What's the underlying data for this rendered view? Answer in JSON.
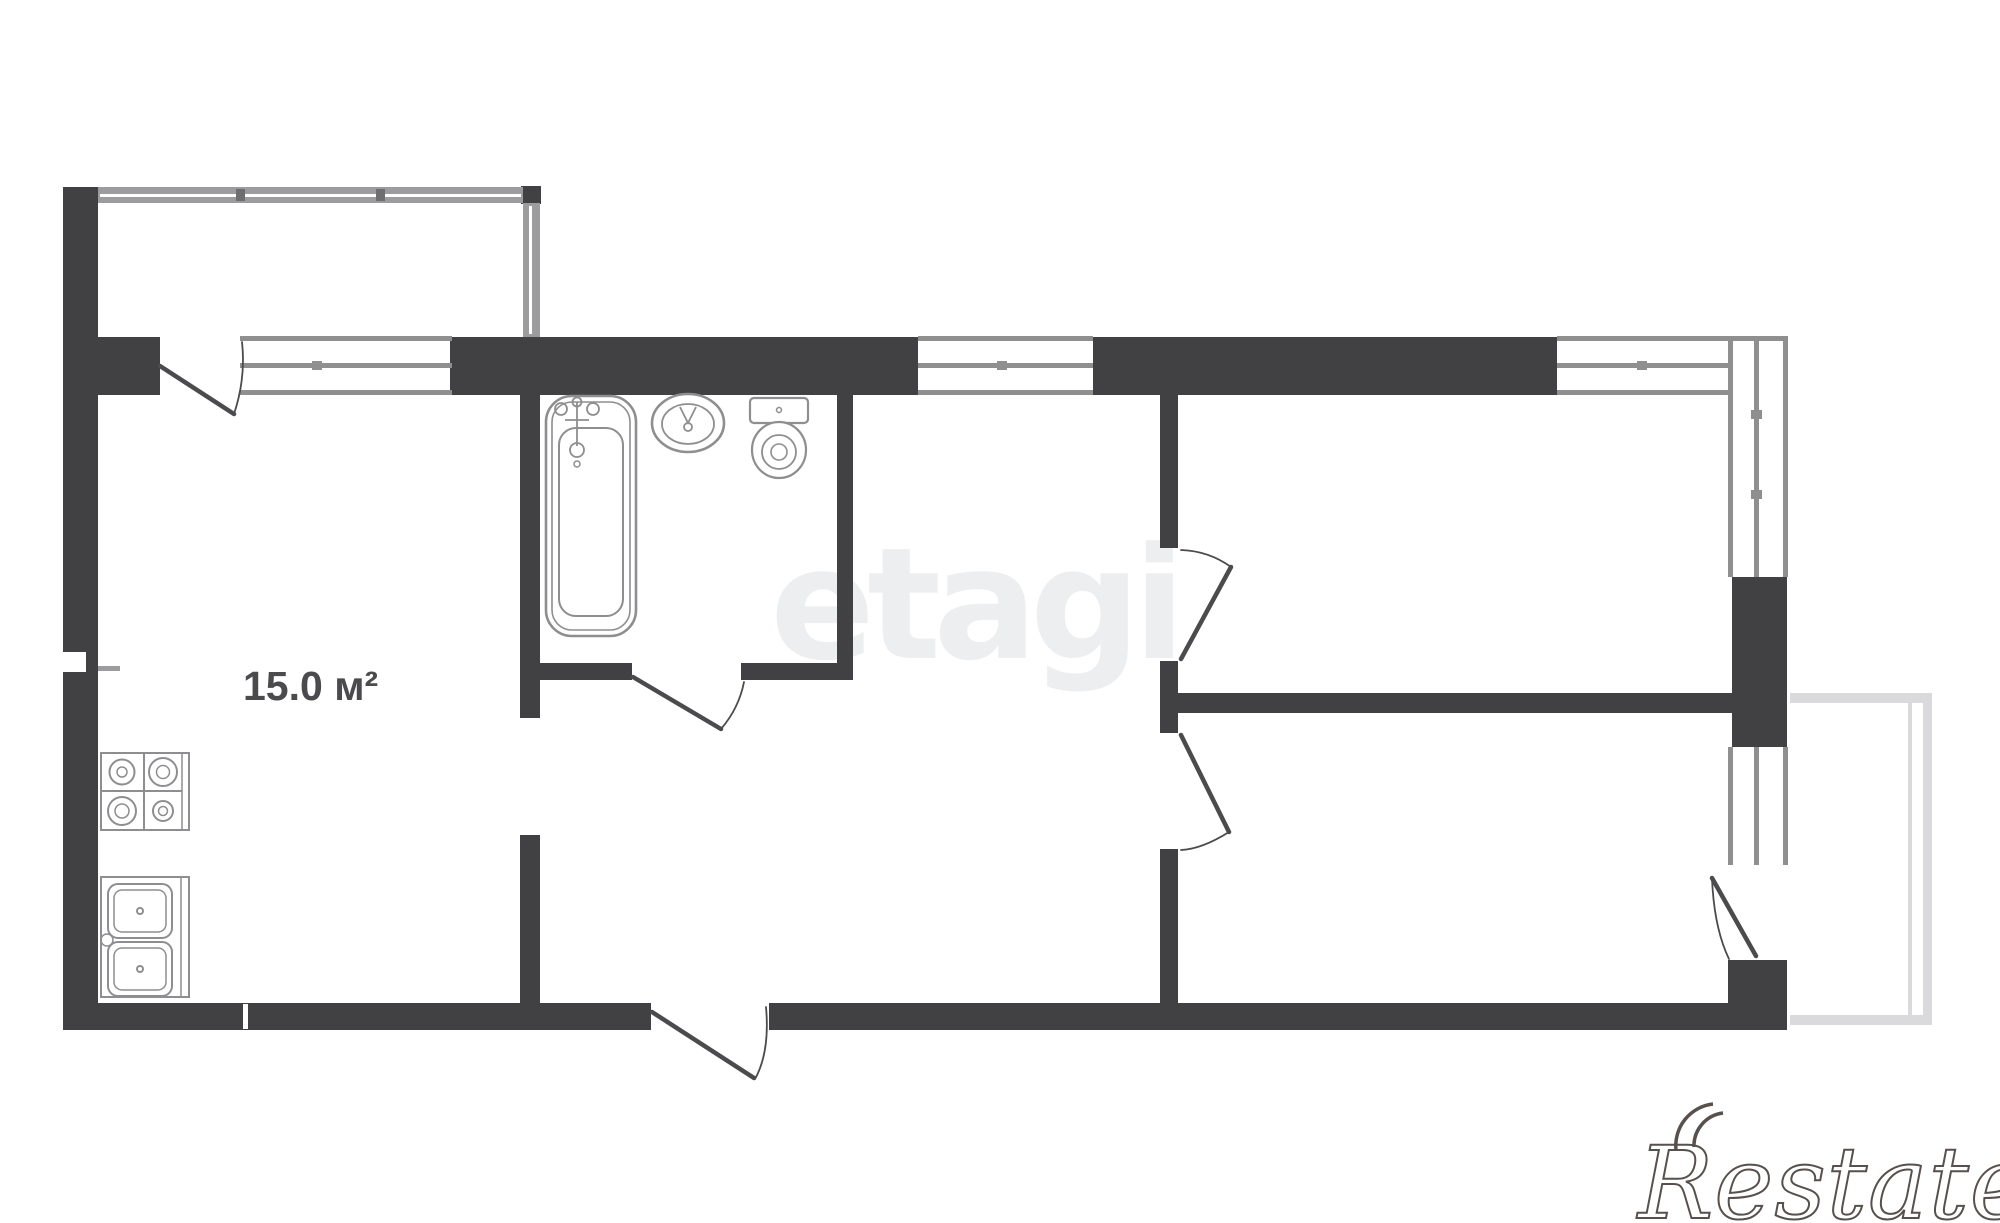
{
  "document": {
    "type": "apartment-floor-plan",
    "background": "#ffffff"
  },
  "colors": {
    "wall": "#414042",
    "window_line": "#8f8f90",
    "glazing": "#9c9c9e",
    "glazing_tick": "#6e6e70",
    "door": "#4b4b4d",
    "fixture": "#8e8e90",
    "balcony": "#dadadc",
    "area_label": "#4b4b4d",
    "watermark_center": "#edeeef",
    "watermark_logo": "#57504c"
  },
  "labels": {
    "kitchen_area": "15.0 м²"
  },
  "watermarks": {
    "center": "etagi",
    "bottom_right": "Restate"
  },
  "fixtures": [
    "bathtub",
    "washbasin",
    "toilet",
    "stove",
    "double-sink"
  ],
  "features": {
    "rooms_with_windows": 4,
    "doors": 6,
    "balconies": 2
  }
}
